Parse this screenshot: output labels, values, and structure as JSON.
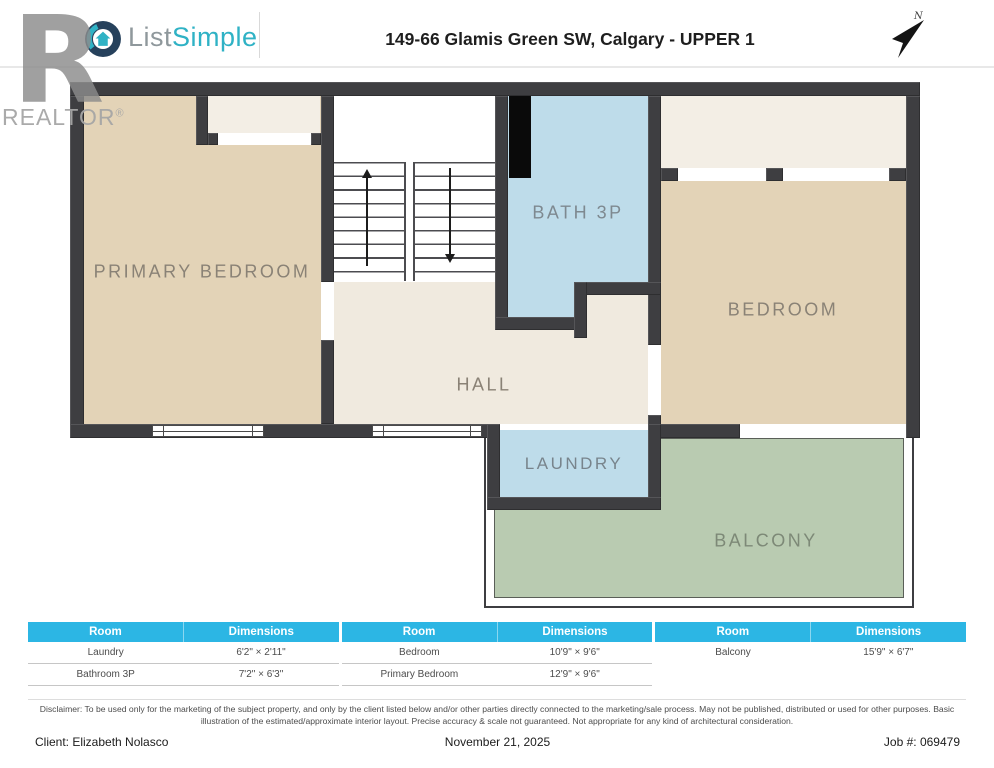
{
  "colors": {
    "wall": "#3e3e41",
    "room_tan": "#e3d3b7",
    "hall_cream": "#f0eadf",
    "closet_cream": "#f3eee5",
    "room_blue": "#bedcea",
    "balcony_green": "#b9cbb1",
    "table_header_cyan": "#2cb6e4",
    "brand_teal": "#2fb2c5",
    "label_gray": "#8a8276"
  },
  "header": {
    "logo_list": "List",
    "logo_simple": "Simple",
    "title": "149-66 Glamis Green SW, Calgary - UPPER 1",
    "compass": "N"
  },
  "watermark": {
    "letter": "R",
    "name": "REALTOR",
    "reg": "®"
  },
  "rooms": {
    "primary_bedroom": "PRIMARY BEDROOM",
    "bath": "BATH 3P",
    "bedroom": "BEDROOM",
    "hall": "HALL",
    "laundry": "LAUNDRY",
    "balcony": "BALCONY"
  },
  "table": {
    "groups": [
      {
        "room_header": "Room",
        "dim_header": "Dimensions",
        "rows": [
          {
            "room": "Laundry",
            "dim": "6'2\" × 2'11\""
          },
          {
            "room": "Bathroom 3P",
            "dim": "7'2\" × 6'3\""
          }
        ]
      },
      {
        "room_header": "Room",
        "dim_header": "Dimensions",
        "rows": [
          {
            "room": "Bedroom",
            "dim": "10'9\" × 9'6\""
          },
          {
            "room": "Primary Bedroom",
            "dim": "12'9\" × 9'6\""
          }
        ]
      },
      {
        "room_header": "Room",
        "dim_header": "Dimensions",
        "rows": [
          {
            "room": "Balcony",
            "dim": "15'9\" × 6'7\""
          }
        ]
      }
    ]
  },
  "disclaimer": "Disclaimer: To be used only for the marketing of the subject property, and only by the client listed below and/or other parties directly connected to the marketing/sale process. May not be published, distributed or used for other purposes. Basic illustration of the estimated/approximate interior layout. Precise accuracy & scale not guaranteed. Not appropriate for any kind of architectural consideration.",
  "footer": {
    "client": "Client: Elizabeth Nolasco",
    "date": "November 21, 2025",
    "job": "Job #: 069479"
  }
}
